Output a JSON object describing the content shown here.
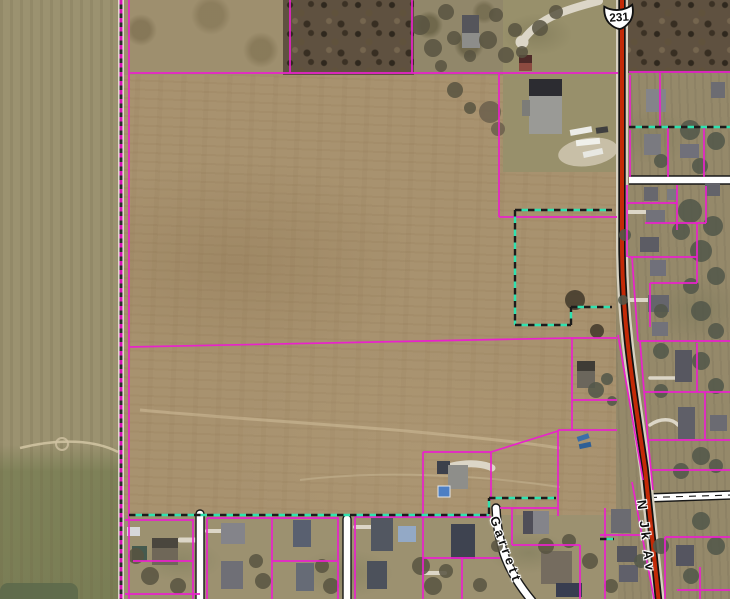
{
  "map": {
    "route_shield": {
      "number": "231"
    },
    "road_labels": [
      {
        "name": "N Jk Av"
      },
      {
        "name": "Garrett"
      }
    ],
    "colors": {
      "parcel_line": "#e922cb",
      "county_dash_magenta": "#d611b5",
      "county_dash_dark": "#2b2b2b",
      "county_casing": "#f4f1e8",
      "city_dash_teal": "#2fe2af",
      "city_dash_dark": "#1c1c1c",
      "highway_fill": "#c32a07",
      "highway_casing": "#121212",
      "road_fill": "#ffffff",
      "road_casing": "#181818",
      "shield_fill": "#ffffff",
      "shield_border": "#111111",
      "label_color": "#101010",
      "label_halo": "#ffffff",
      "field": "#a8926f",
      "field_west": "#9b9270",
      "field_green": "#7e8158",
      "woods": "#5f5140",
      "farmstead": "#98906b",
      "residential_east": "#95896a",
      "residential_south": "#9c9170"
    }
  }
}
